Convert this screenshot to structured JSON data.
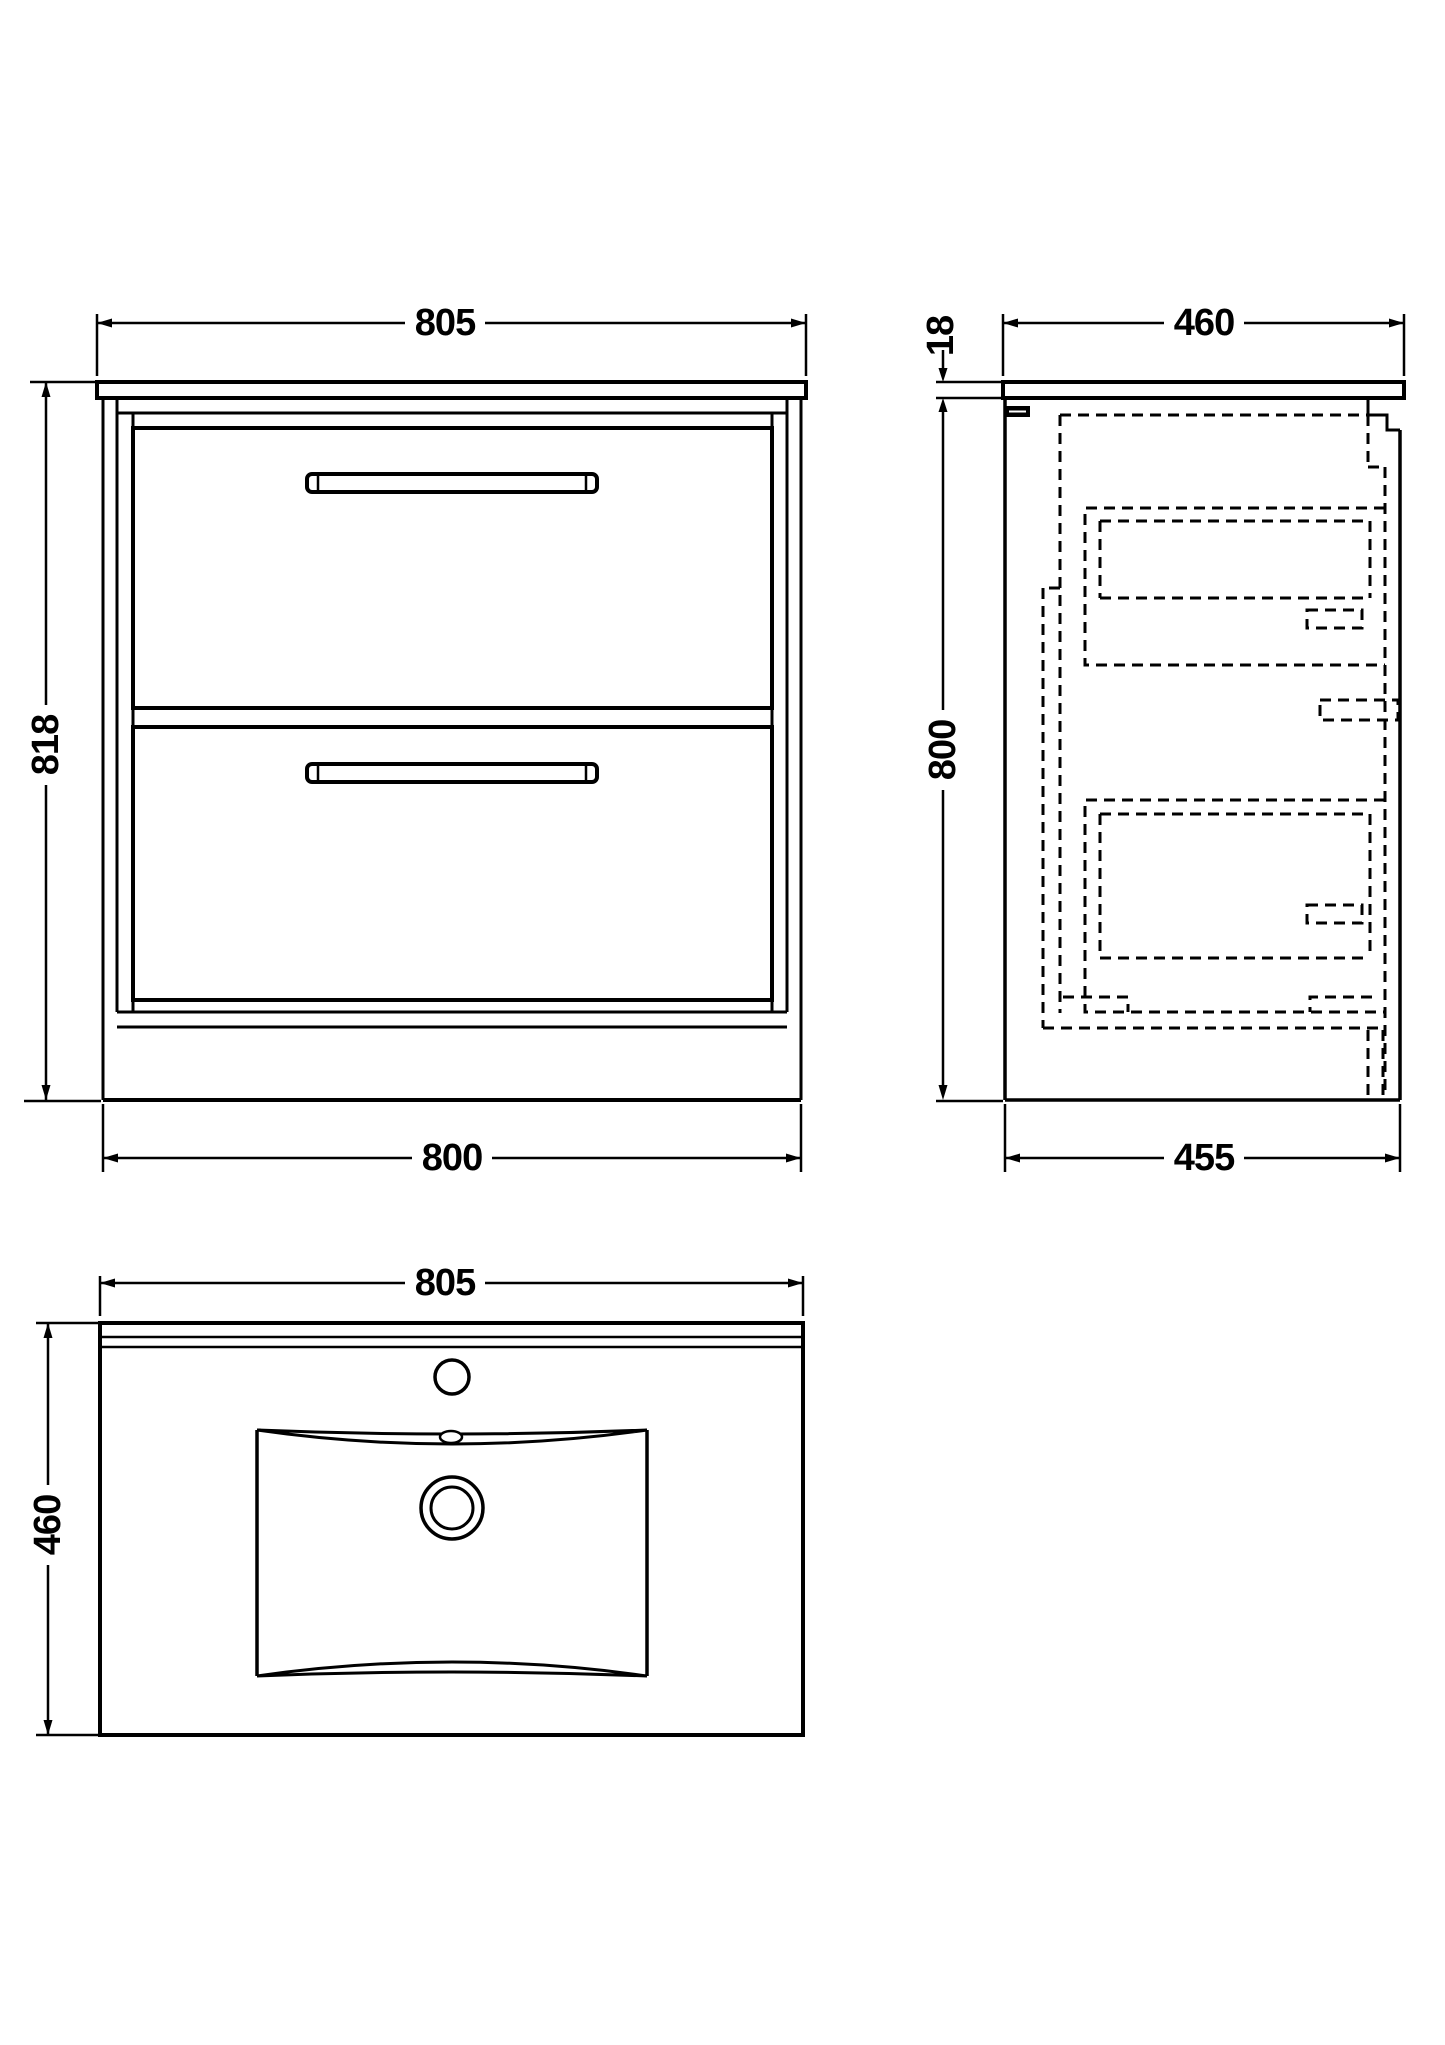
{
  "drawing": {
    "background": "#ffffff",
    "line_color": "#000000",
    "front_view": {
      "width_top": "805",
      "height": "818",
      "width_bottom": "800"
    },
    "side_view": {
      "counter_thickness": "18",
      "depth_top": "460",
      "height": "800",
      "depth_bottom": "455"
    },
    "plan_view": {
      "width": "805",
      "depth": "460"
    }
  }
}
